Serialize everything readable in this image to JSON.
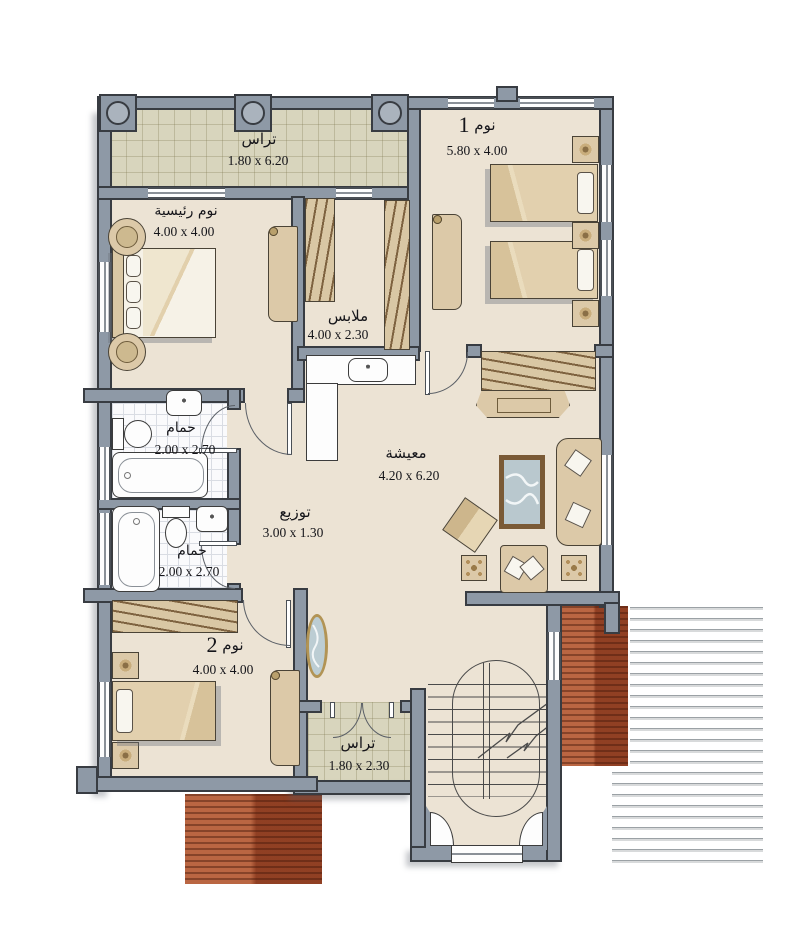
{
  "title": "villa-floor-plan",
  "colors": {
    "wall": "#8e99a6",
    "wall_outline": "#383c42",
    "floor": "#ece3d4",
    "terrace": "#d8d5bd",
    "wood_deck": "#a3492a",
    "furniture": "#dcc9a8",
    "glass": "#b9c8ce",
    "text": "#15151a"
  },
  "rooms": [
    {
      "id": "terrace-top",
      "name": "تراس",
      "dims": "1.80 x 6.20"
    },
    {
      "id": "bedroom-1",
      "name": "نوم",
      "number": "1",
      "dims": "5.80 x 4.00"
    },
    {
      "id": "master-bedroom",
      "name": "نوم رئيسية",
      "dims": "4.00 x 4.00"
    },
    {
      "id": "closet",
      "name": "ملابس",
      "dims": "4.00 x 2.30"
    },
    {
      "id": "bath-1",
      "name": "حمام",
      "dims": "2.00 x 2.70"
    },
    {
      "id": "bath-2",
      "name": "حمام",
      "dims": "2.00 x 2.70"
    },
    {
      "id": "hall",
      "name": "توزيع",
      "dims": "3.00 x 1.30"
    },
    {
      "id": "living",
      "name": "معيشة",
      "dims": "4.20 x 6.20"
    },
    {
      "id": "bedroom-2",
      "name": "نوم",
      "number": "2",
      "dims": "4.00 x 4.00"
    },
    {
      "id": "terrace-bottom",
      "name": "تراس",
      "dims": "1.80 x 2.30"
    }
  ]
}
